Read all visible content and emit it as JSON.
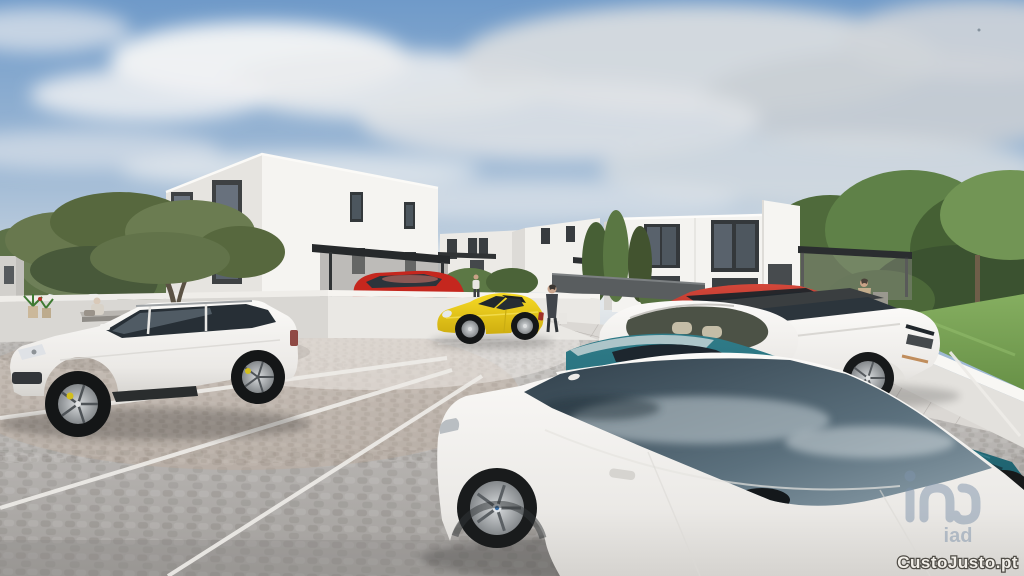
{
  "watermark": {
    "logo_text": "iad",
    "site_text": "CustoJusto.pt",
    "logo_color": "#7e93ab",
    "site_text_fill": "#f2efe9",
    "site_text_outline": "#4f4c46"
  },
  "scene": {
    "type": "3d-architectural-render-real-estate",
    "sky": {
      "top": "#6f9ac9",
      "horizon": "#d8dde2",
      "clouds": "#d7dbdf"
    },
    "buildings": [
      {
        "name": "main-two-storey-house",
        "facade": "#f5f4f1",
        "window_frames": "#3b3f42"
      },
      {
        "name": "rear-house-left",
        "facade": "#eceae6"
      },
      {
        "name": "rear-house-center",
        "facade": "#f2f1ed"
      },
      {
        "name": "duplex-house-right",
        "facade": "#f4f3f0"
      },
      {
        "name": "house-edge-far-right",
        "facade": "#f6f5f2"
      }
    ],
    "vehicles": [
      {
        "name": "white-suv-left",
        "color": "#f4f3f0"
      },
      {
        "name": "yellow-convertible",
        "color": "#edd31c"
      },
      {
        "name": "red-hatchback-carport",
        "color": "#c5271e"
      },
      {
        "name": "red-suv-row",
        "color": "#bb3a30"
      },
      {
        "name": "white-crossover-row",
        "color": "#f2f1ee"
      },
      {
        "name": "white-range-rover-row",
        "color": "#f2f1ee"
      },
      {
        "name": "teal-sedan",
        "color": "#276f7d"
      },
      {
        "name": "white-coupe-foreground",
        "color": "#f4f3f0"
      }
    ],
    "people": [
      "person-sitting-on-bench",
      "person-at-house-door",
      "man-dark-suit-with-bag",
      "man-beige-coat-walking"
    ],
    "ground": {
      "cobblestone": "#b5b2af",
      "marking_lines": "#eeece8",
      "grass": "#7aa557",
      "walkway": "#dbd8d4"
    }
  }
}
